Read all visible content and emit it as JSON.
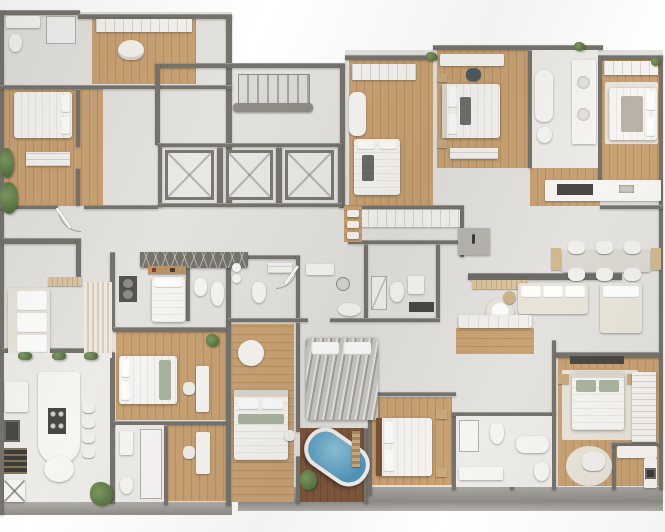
{
  "scene": {
    "type": "3d-floorplan-render",
    "description": "Top-down 3D architectural rendering of a residential building floor plate with multiple apartment units, central elevator core with three cabins, a stair hall, corridors, bedrooms with wood floors, bathrooms, kitchens and living/dining areas",
    "rooms": [
      {
        "name": "bathroom-top-left",
        "floor": "tile"
      },
      {
        "name": "wardrobe-room-top-left",
        "floor": "wood"
      },
      {
        "name": "bedroom-top-left",
        "floor": "wood"
      },
      {
        "name": "stair-hall",
        "floor": "tile"
      },
      {
        "name": "elevator-bank",
        "cabins": 3
      },
      {
        "name": "corridor",
        "floor": "tile"
      },
      {
        "name": "bedroom-a",
        "floor": "wood"
      },
      {
        "name": "bedroom-b",
        "floor": "wood"
      },
      {
        "name": "bathroom-top-right",
        "floor": "tile"
      },
      {
        "name": "bedroom-c",
        "floor": "wood"
      },
      {
        "name": "kitchen-top-right",
        "floor": "tile"
      },
      {
        "name": "living-dining-right",
        "floor": "tile"
      },
      {
        "name": "staff-room",
        "floor": "tile"
      },
      {
        "name": "central-bathrooms",
        "count": 3
      },
      {
        "name": "living-room-left",
        "floor": "tile"
      },
      {
        "name": "kitchen-left",
        "floor": "tile"
      },
      {
        "name": "bedroom-d",
        "floor": "wood"
      },
      {
        "name": "bedroom-e",
        "floor": "wood"
      },
      {
        "name": "gray-bed-room",
        "floor": "tile"
      },
      {
        "name": "spa-bath-room",
        "floor": "dark-wood",
        "feature": "freestanding-blue-tub"
      },
      {
        "name": "bedroom-f",
        "floor": "wood"
      },
      {
        "name": "master-suite-right",
        "floor": "wood"
      },
      {
        "name": "kitchen-bottom-right",
        "floor": "tile"
      }
    ]
  },
  "palette": {
    "background": "#ffffff",
    "floor_light": "#e4e2de",
    "floor_warm": "#edebe7",
    "wall": "#76736d",
    "wall_dark": "#5e5c57",
    "wood_light": "#c9a274",
    "wood_mid": "#b8905f",
    "furn_white": "#f6f5f2",
    "cream": "#e9e4da",
    "tub_water": "#4f96bb",
    "plant_green": "#55713f"
  }
}
